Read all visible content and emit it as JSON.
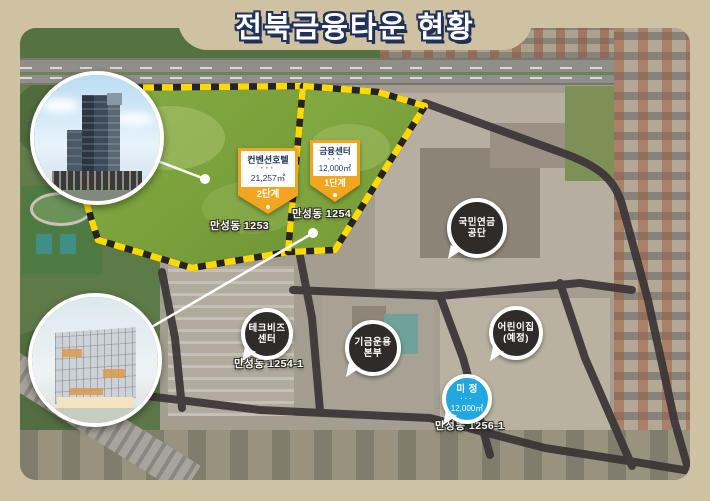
{
  "title": "전북금융타운 현황",
  "map": {
    "parcels": [
      {
        "lot": "만성동 1253",
        "badge": {
          "name": "컨벤션호텔",
          "dots": "···",
          "area": "21,257㎡",
          "phase": "2단계"
        }
      },
      {
        "lot": "만성동 1254",
        "badge": {
          "name": "금융센터",
          "dots": "···",
          "area": "12,000㎡",
          "phase": "1단계"
        }
      }
    ],
    "sites": [
      {
        "name": "국민연금공단",
        "lines": [
          "국민연금",
          "공단"
        ]
      },
      {
        "name": "테크비즈센터",
        "lines": [
          "테크비즈",
          "센터"
        ],
        "lot": "만성동 1254-1"
      },
      {
        "name": "기금운용본부",
        "lines": [
          "기금운용",
          "본부"
        ]
      },
      {
        "name": "어린이집(예정)",
        "lines": [
          "어린이집",
          "(예정)"
        ]
      },
      {
        "name": "미정",
        "label": "미 정",
        "dots": "···",
        "area": "12,000㎡",
        "lot": "만성동 1256-1"
      }
    ],
    "callouts": [
      {
        "name": "convention-hotel-rendering"
      },
      {
        "name": "financial-center-rendering"
      }
    ]
  },
  "colors": {
    "frame": "#cfc2a2",
    "title_text": "#ffffff",
    "title_outline": "#22325c",
    "parcel_green": "#7ea43e",
    "dash_yellow": "#ffd900",
    "road_dark": "#3b3437",
    "badge_orange": "#f2a51e",
    "badge_navy": "#1d3156",
    "bubble_dark": "#2e2b29",
    "bubble_blue": "#23a7e1"
  }
}
